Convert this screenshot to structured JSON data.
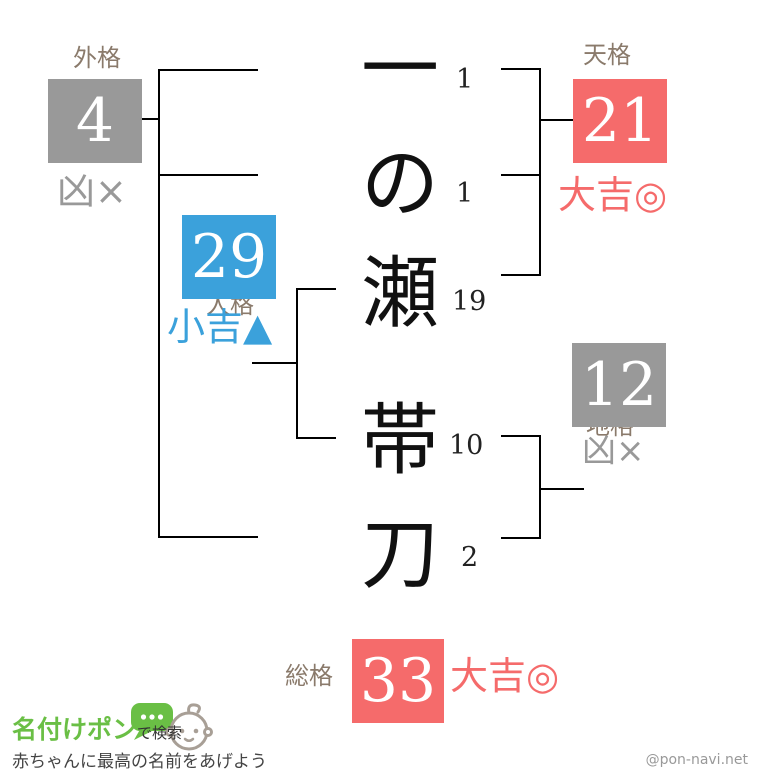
{
  "name_chars": [
    {
      "char": "一",
      "strokes": "1"
    },
    {
      "char": "の",
      "strokes": "1"
    },
    {
      "char": "瀬",
      "strokes": "19"
    },
    {
      "char": "帯",
      "strokes": "10"
    },
    {
      "char": "刀",
      "strokes": "2"
    }
  ],
  "kaku": {
    "gaikaku": {
      "label": "外格",
      "value": "4",
      "fortune": "凶×"
    },
    "tenkaku": {
      "label": "天格",
      "value": "21",
      "fortune": "大吉◎"
    },
    "jinkaku": {
      "label": "人格",
      "value": "29",
      "fortune": "小吉▲"
    },
    "chikaku": {
      "label": "地格",
      "value": "12",
      "fortune": "凶×"
    },
    "soukaku": {
      "label": "総格",
      "value": "33",
      "fortune": "大吉◎"
    }
  },
  "colors": {
    "lucky_red": "#f56b6b",
    "bad_gray": "#999999",
    "semi_blue": "#3ba1db",
    "label_brown": "#8a7a6b",
    "logo_green": "#6abf45"
  },
  "footer": {
    "logo_main": "名付けポン",
    "logo_suffix": "で検索",
    "tagline": "赤ちゃんに最高の名前をあげよう",
    "credit": "@pon-navi.net"
  }
}
